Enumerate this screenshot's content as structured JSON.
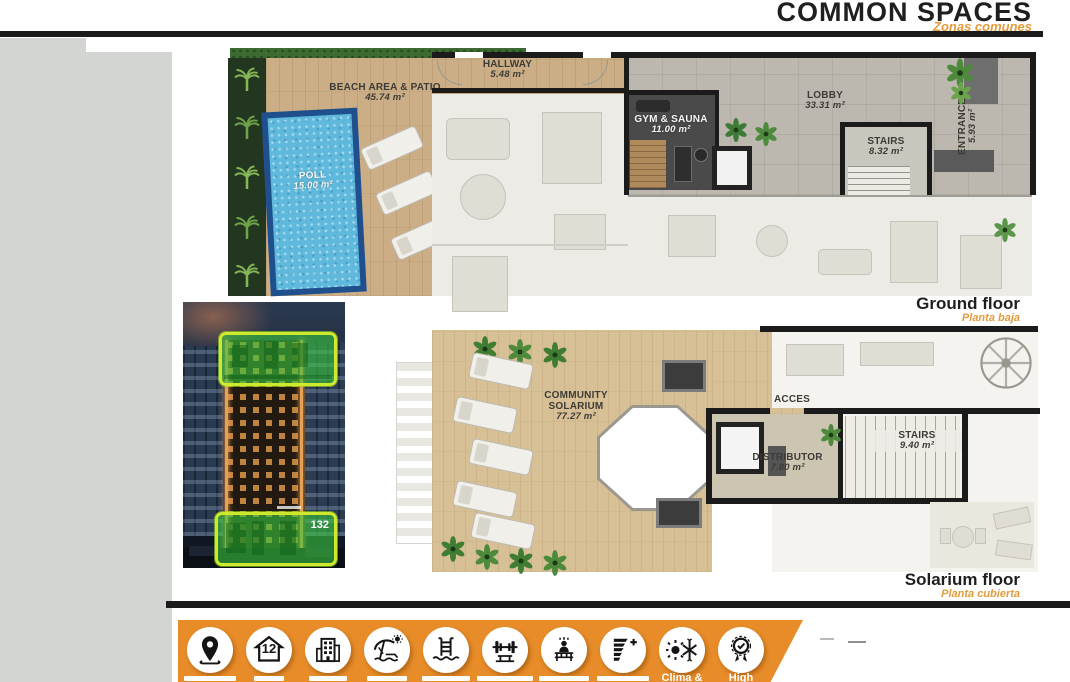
{
  "header": {
    "title": "COMMON SPACES",
    "subtitle": "Zonas comunes"
  },
  "ground_floor": {
    "heading": "Ground floor",
    "subheading": "Planta baja",
    "beach": {
      "name": "BEACH AREA & PATIO",
      "area": "45.74 m²"
    },
    "hallway": {
      "name": "HALLWAY",
      "area": "5.48 m²"
    },
    "pool": {
      "name": "POLL",
      "area": "15.00 m²"
    },
    "gym": {
      "name": "GYM & SAUNA",
      "area": "11.00 m²"
    },
    "lobby": {
      "name": "LOBBY",
      "area": "33.31 m²"
    },
    "stairs": {
      "name": "STAIRS",
      "area": "8.32 m²"
    },
    "entrance": {
      "name": "ENTRANCE",
      "area": "5.93 m²"
    }
  },
  "solarium_floor": {
    "heading": "Solarium floor",
    "subheading": "Planta cubierta",
    "solarium": {
      "name": "COMMUNITY SOLARIUM",
      "area": "77.27 m²"
    },
    "acces": {
      "name": "ACCES"
    },
    "distributor": {
      "name": "DISTRIBUTOR",
      "area": "7.80 m²"
    },
    "stairs": {
      "name": "STAIRS",
      "area": "9.40 m²"
    }
  },
  "photo": {
    "unit_badge": "132"
  },
  "amenities": {
    "icons": [
      {
        "name": "location-pin",
        "label": ""
      },
      {
        "name": "house-12",
        "label": "",
        "glyph": "12"
      },
      {
        "name": "building",
        "label": ""
      },
      {
        "name": "beach-umbrella",
        "label": ""
      },
      {
        "name": "pool-ladder",
        "label": ""
      },
      {
        "name": "gym-barbell",
        "label": ""
      },
      {
        "name": "sauna",
        "label": ""
      },
      {
        "name": "energy-efficiency",
        "label": ""
      },
      {
        "name": "climate",
        "label": "Clima &"
      },
      {
        "name": "quality-badge",
        "label": "High"
      }
    ]
  },
  "colors": {
    "accent_orange": "#e78c28",
    "subtitle_orange": "#e39b3c",
    "highlight_green": "#38c43e",
    "highlight_border": "#cdea2f",
    "pool_blue": "#5fb9dd"
  }
}
